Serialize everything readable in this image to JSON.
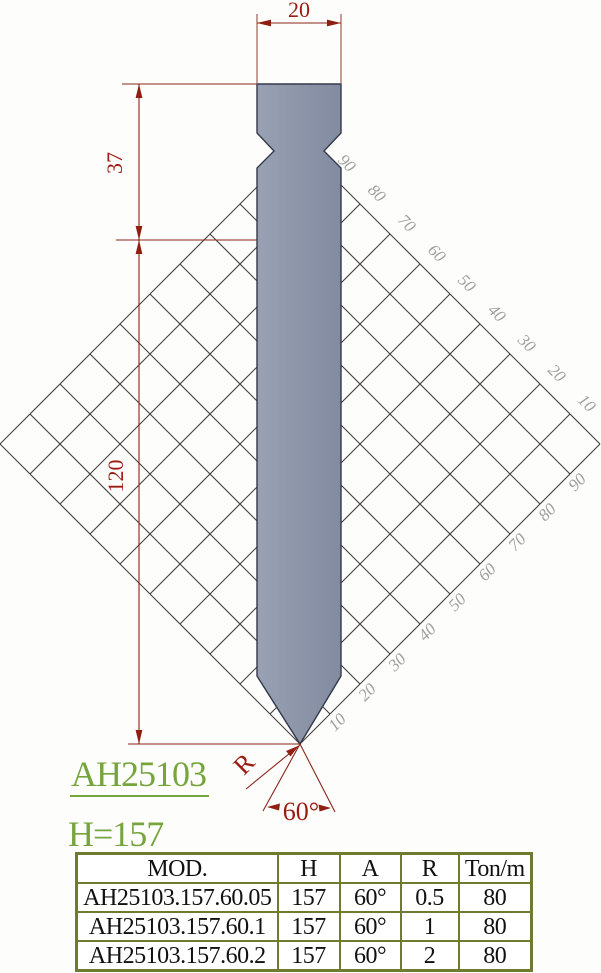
{
  "drawing": {
    "dim_width": "20",
    "dim_upper": "37",
    "dim_lower": "120",
    "tip_radius_label": "R",
    "tip_angle_label": "60°",
    "grid": {
      "upper_labels": [
        "90",
        "80",
        "70",
        "60",
        "50",
        "40",
        "30",
        "20",
        "10"
      ],
      "lower_labels": [
        "10",
        "20",
        "30",
        "40",
        "50",
        "60",
        "70",
        "80",
        "90"
      ]
    },
    "colors": {
      "dimension_red": "#9c1b10",
      "tool_gray_blue": "#8c94a8",
      "grid_line_gray": "#423e3e",
      "grid_label_gray": "#9f9f9f",
      "accent_green": "#76a43d",
      "table_border_olive": "#6f7c30"
    }
  },
  "labels": {
    "model": "AH25103",
    "height": "H=157"
  },
  "table": {
    "headers": [
      "MOD.",
      "H",
      "A",
      "R",
      "Ton/m"
    ],
    "rows": [
      [
        "AH25103.157.60.05",
        "157",
        "60°",
        "0.5",
        "80"
      ],
      [
        "AH25103.157.60.1",
        "157",
        "60°",
        "1",
        "80"
      ],
      [
        "AH25103.157.60.2",
        "157",
        "60°",
        "2",
        "80"
      ]
    ]
  }
}
